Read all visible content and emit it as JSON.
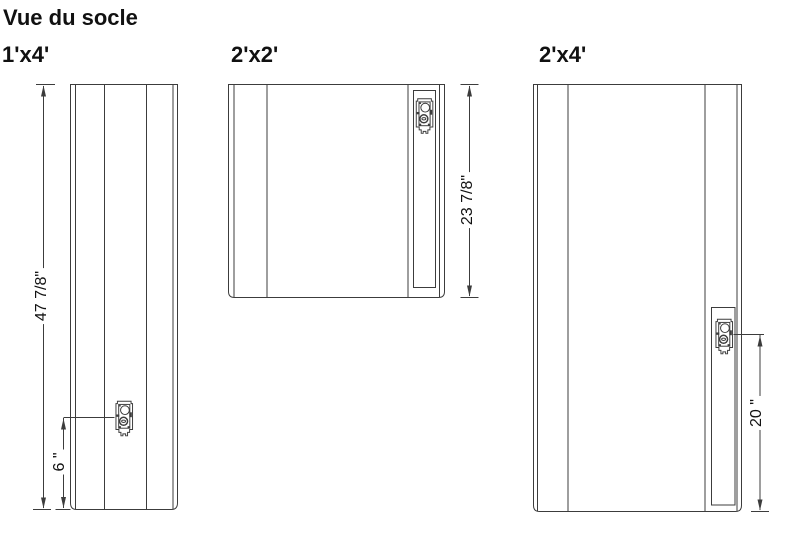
{
  "title": "Vue du socle",
  "panels": [
    {
      "id": "1x4",
      "label": "1'x4'",
      "height_dim": "47 7/8\"",
      "connector_offset_dim": "6 \""
    },
    {
      "id": "2x2",
      "label": "2'x2'",
      "height_dim": "23 7/8\""
    },
    {
      "id": "2x4",
      "label": "2'x4'",
      "connector_offset_dim": "20 \""
    }
  ],
  "icons": {
    "connector": "mounting-connector-icon"
  },
  "colors": {
    "background": "#ffffff",
    "line": "#3c3c3c",
    "text": "#111111"
  }
}
